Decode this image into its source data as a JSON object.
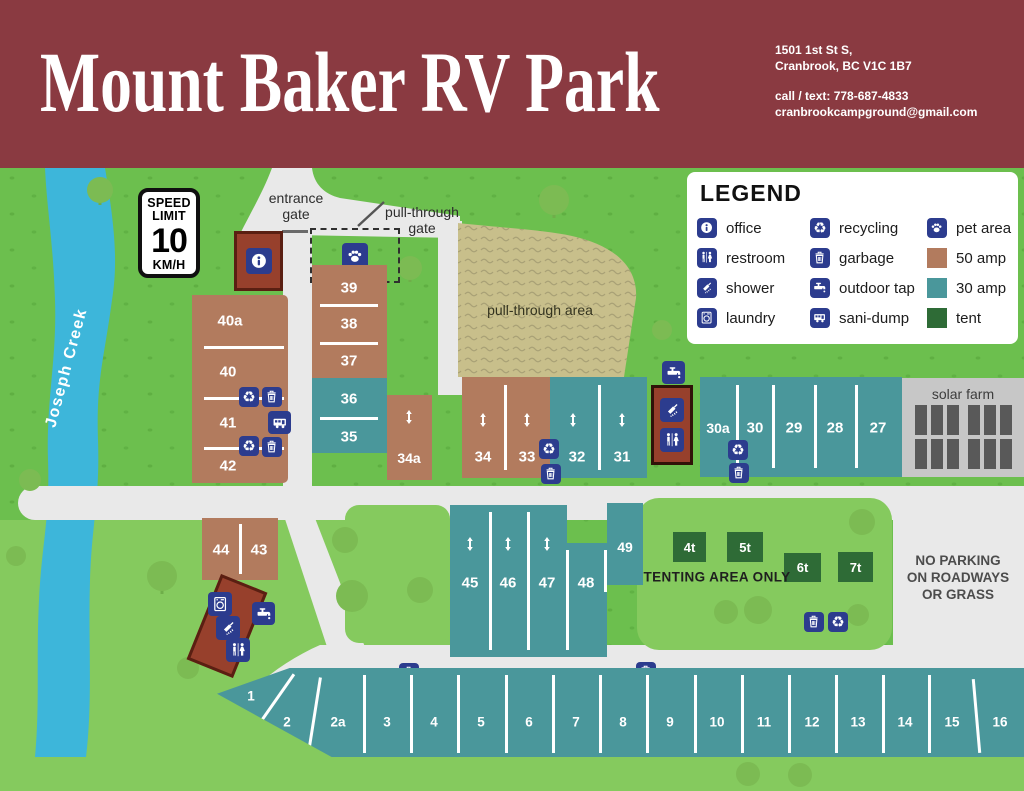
{
  "header": {
    "title": "Mount Baker RV Park",
    "address_line1": "1501 1st St S,",
    "address_line2": "Cranbrook, BC V1C 1B7",
    "contact_line1": "call / text: 778-687-4833",
    "contact_line2": "cranbrookcampground@gmail.com"
  },
  "legend": {
    "title": "LEGEND",
    "items": [
      {
        "icon": "info-icon",
        "label": "office"
      },
      {
        "icon": "restroom-icon",
        "label": "restroom"
      },
      {
        "icon": "shower-icon",
        "label": "shower"
      },
      {
        "icon": "laundry-icon",
        "label": "laundry"
      },
      {
        "icon": "recycling-icon",
        "label": "recycling"
      },
      {
        "icon": "garbage-icon",
        "label": "garbage"
      },
      {
        "icon": "outdoor-tap-icon",
        "label": "outdoor tap"
      },
      {
        "icon": "sani-dump-icon",
        "label": "sani-dump"
      },
      {
        "icon": "paw-icon",
        "label": "pet area"
      },
      {
        "icon": "swatch-50amp",
        "label": "50 amp"
      },
      {
        "icon": "swatch-30amp",
        "label": "30 amp"
      },
      {
        "icon": "swatch-tent",
        "label": "tent"
      }
    ]
  },
  "map": {
    "speed_sign": {
      "l1": "SPEED",
      "l2": "LIMIT",
      "value": "10",
      "unit": "KM/H"
    },
    "creek_label": "Joseph Creek",
    "entrance_gate_l1": "entrance",
    "entrance_gate_l2": "gate",
    "pt_gate_l1": "pull-through",
    "pt_gate_l2": "gate",
    "pt_area": "pull-through area",
    "tenting": "TENTING AREA ONLY",
    "no_parking_l1": "NO PARKING",
    "no_parking_l2": "ON ROADWAYS",
    "no_parking_l3": "OR GRASS",
    "solar_farm": "solar farm"
  },
  "sites": {
    "left_col": [
      "40a",
      "40",
      "41",
      "42"
    ],
    "mid_col_50": [
      "39",
      "38",
      "37"
    ],
    "mid_col_30": [
      "36",
      "35"
    ],
    "s34a": "34a",
    "row_50": [
      "34",
      "33"
    ],
    "row_30": [
      "32",
      "31"
    ],
    "east_row": [
      "30a",
      "30",
      "29",
      "28",
      "27"
    ],
    "south_row": [
      "45",
      "46",
      "47",
      "48"
    ],
    "s49": "49",
    "s44_43": [
      "44",
      "43"
    ],
    "tents": [
      "4t",
      "5t",
      "6t",
      "7t"
    ],
    "bottom_row": [
      "1",
      "2",
      "2a",
      "3",
      "4",
      "5",
      "6",
      "7",
      "8",
      "9",
      "10",
      "11",
      "12",
      "13",
      "14",
      "15",
      "16"
    ]
  },
  "icons": {
    "recycling_glyph": "♻"
  },
  "colors": {
    "header": "#8a3a41",
    "grass": "#6cbf4e",
    "grass_light": "#85ca5e",
    "road": "#e9e9e9",
    "creek": "#3db6da",
    "amp50": "#b27b5e",
    "amp30": "#4a979b",
    "tent": "#2e6b36",
    "icon_blue": "#2c3c8e",
    "building": "#97402c",
    "pull_through": "#c8bf8b",
    "solar": "#c7c7c7"
  }
}
